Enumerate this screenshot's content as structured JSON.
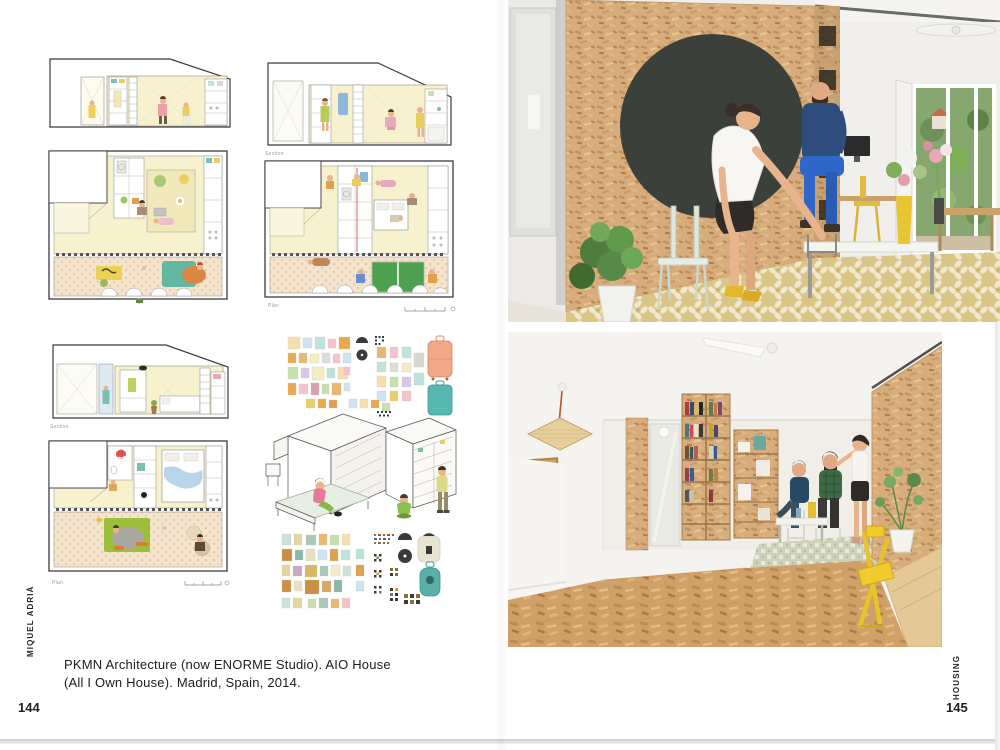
{
  "left_page": {
    "page_number": "144",
    "spine_label": "MIQUEL ADRIÀ",
    "caption": {
      "line1": "PKMN Architecture (now ENORME Studio). AIO House",
      "line2": "(All I Own House). Madrid, Spain, 2014."
    },
    "figure_labels": {
      "section_top": "Section",
      "plan_top": "Plan",
      "section_bottom": "Section",
      "plan_bottom": "Plan"
    }
  },
  "right_page": {
    "page_number": "145",
    "spine_label": "HOUSING"
  },
  "colors": {
    "osb_panel": "#d7ad7c",
    "osb_floor": "#cfa168",
    "chalkboard_circle": "#3c403b",
    "plan_room_yellow": "#f8f1cd",
    "terrace_tan": "#f5e4cd",
    "tile_floor_yellow": "#d9c687",
    "tile_floor_green": "#cdd4ba",
    "accent_yellow": "#e9c234",
    "pingpong_green": "#4da04d",
    "rug_teal": "#62b8a0",
    "rug_green": "#9cc03c",
    "shirt_navy": "#2e4d7d",
    "pants_blue": "#2f67c8",
    "skin": "#e8b48e"
  }
}
